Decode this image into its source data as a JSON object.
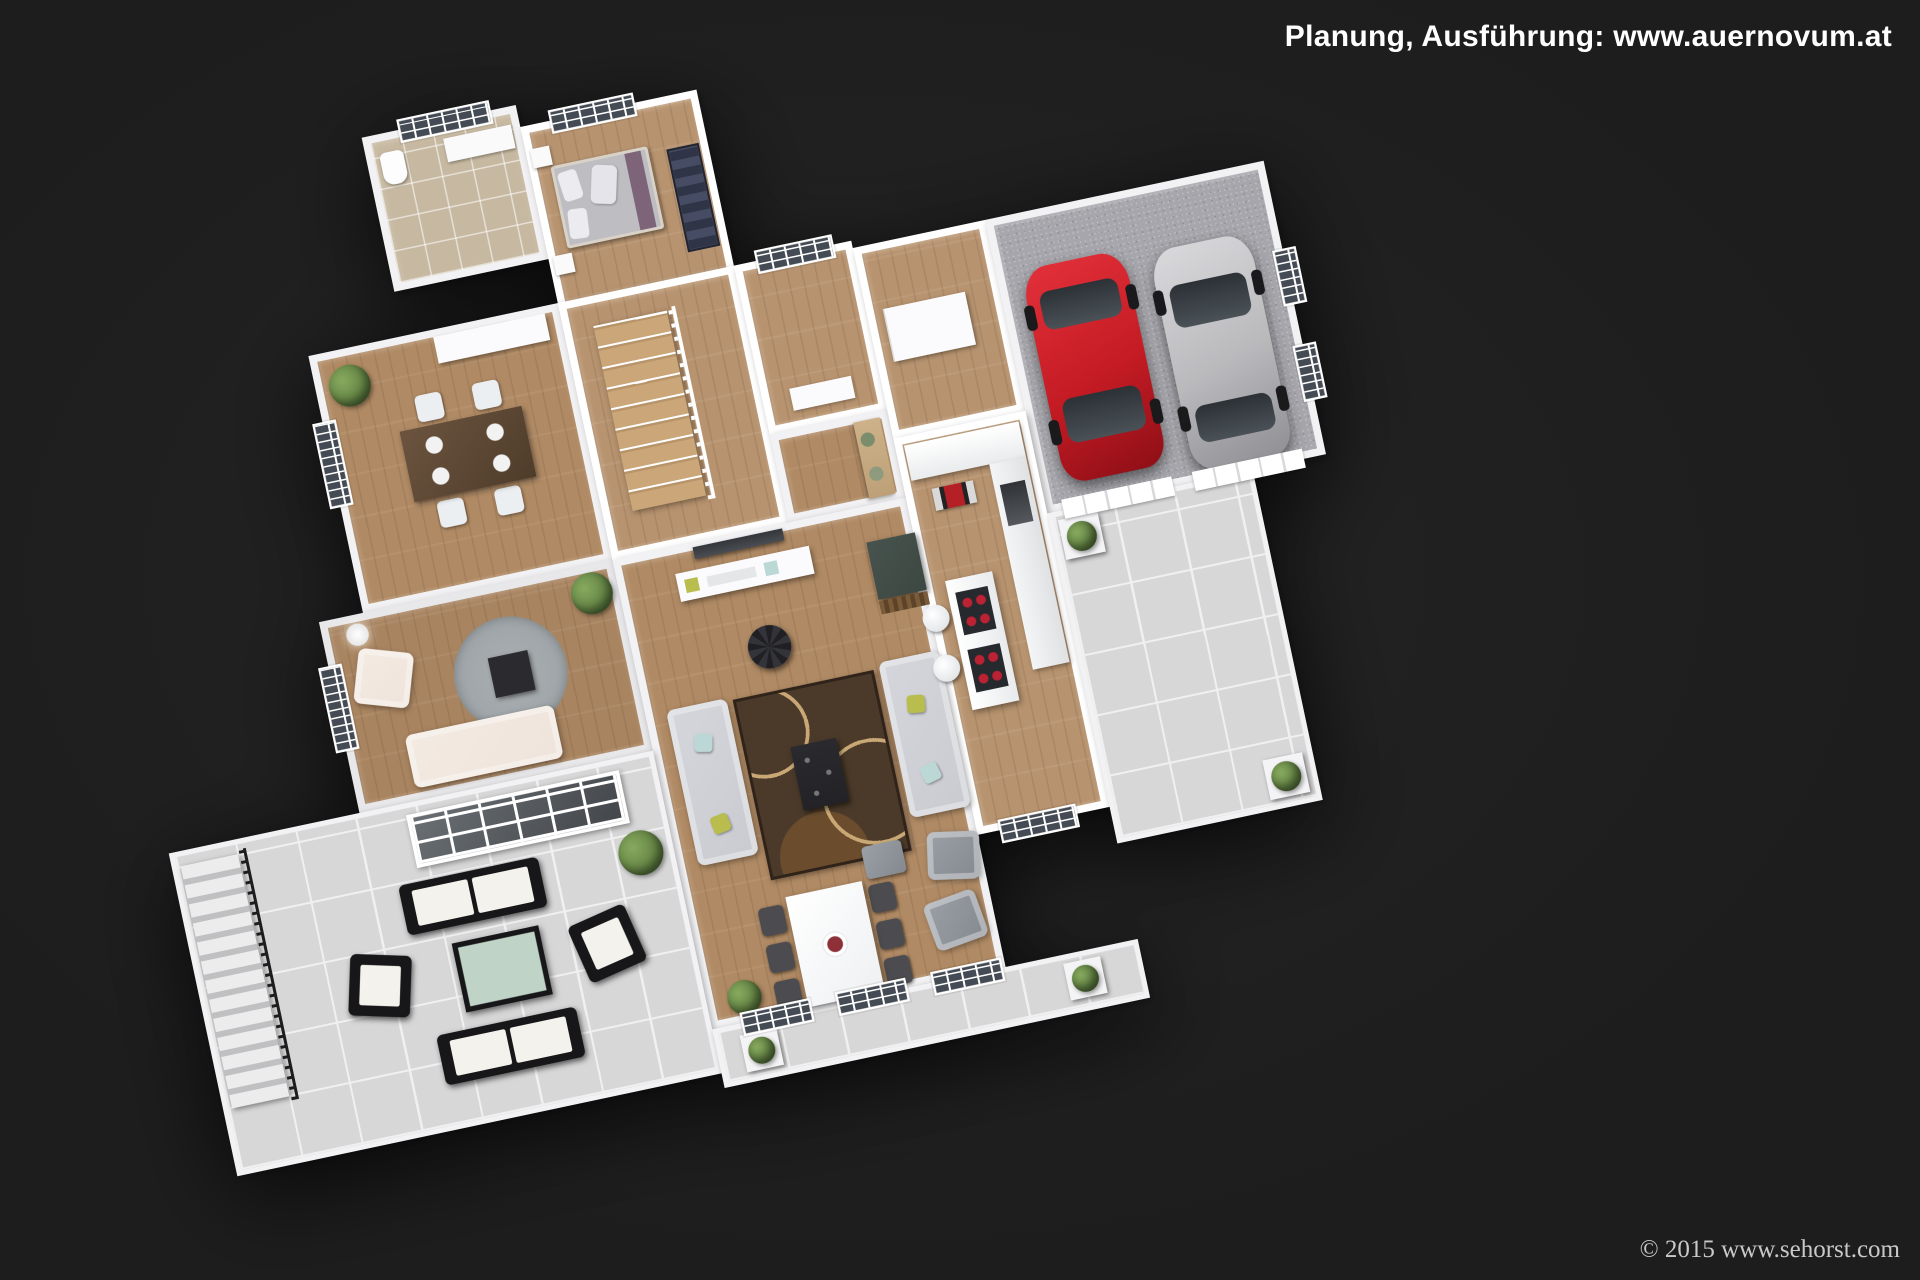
{
  "image": {
    "type": "3d-floor-plan-render",
    "description": "Bird's-eye 3D rendering of a furnished single-storey house floor plan with double garage, two cars and tiled terraces on a black background"
  },
  "overlays": {
    "planner_credit": "Planung, Ausführung: www.auernovum.at",
    "render_copyright": "© 2015 www.sehorst.com"
  },
  "objects": [
    "bathroom",
    "bedroom",
    "dining-room",
    "lounge",
    "stair-hall",
    "staircase",
    "hallway",
    "entry-hall",
    "utility-room",
    "garage",
    "red-car",
    "silver-car",
    "living-room",
    "tv",
    "media-console",
    "sofas",
    "coffee-table",
    "round-pouf",
    "dining-table",
    "fruit-bowl",
    "kitchen",
    "kitchen-island",
    "bar-stools",
    "fireplace",
    "left-terrace",
    "patio-lounge-set",
    "outdoor-staircase",
    "skylight-grid",
    "planter-boxes"
  ],
  "colors": {
    "background": "#1d1d1d",
    "wall": "#f2f2f4",
    "wood_floor": "#b08a64",
    "tile_bathroom": "#c7b9a1",
    "terrace_tile": "#d7d7d7",
    "terrace_grout": "#f0f0f0",
    "garage_floor": "#a6a6ac",
    "red_car": "#c41b24",
    "silver_car": "#b9b9bc",
    "sofa_gray": "#c9cbd1",
    "sofa_cream": "#efe4dc",
    "rug_brown": "#4b3a2a",
    "rug_gray": "#9aa0a3",
    "patio_black": "#17171a",
    "patio_cushion": "#f4f2ec",
    "patio_glass": "#bfd3c6",
    "accent_lime": "#b9bd4e",
    "accent_teal": "#bcd8d6",
    "bed_runner": "#7d6478",
    "plant_green": "#5d7d3f",
    "fireplace": "#3c4742"
  }
}
